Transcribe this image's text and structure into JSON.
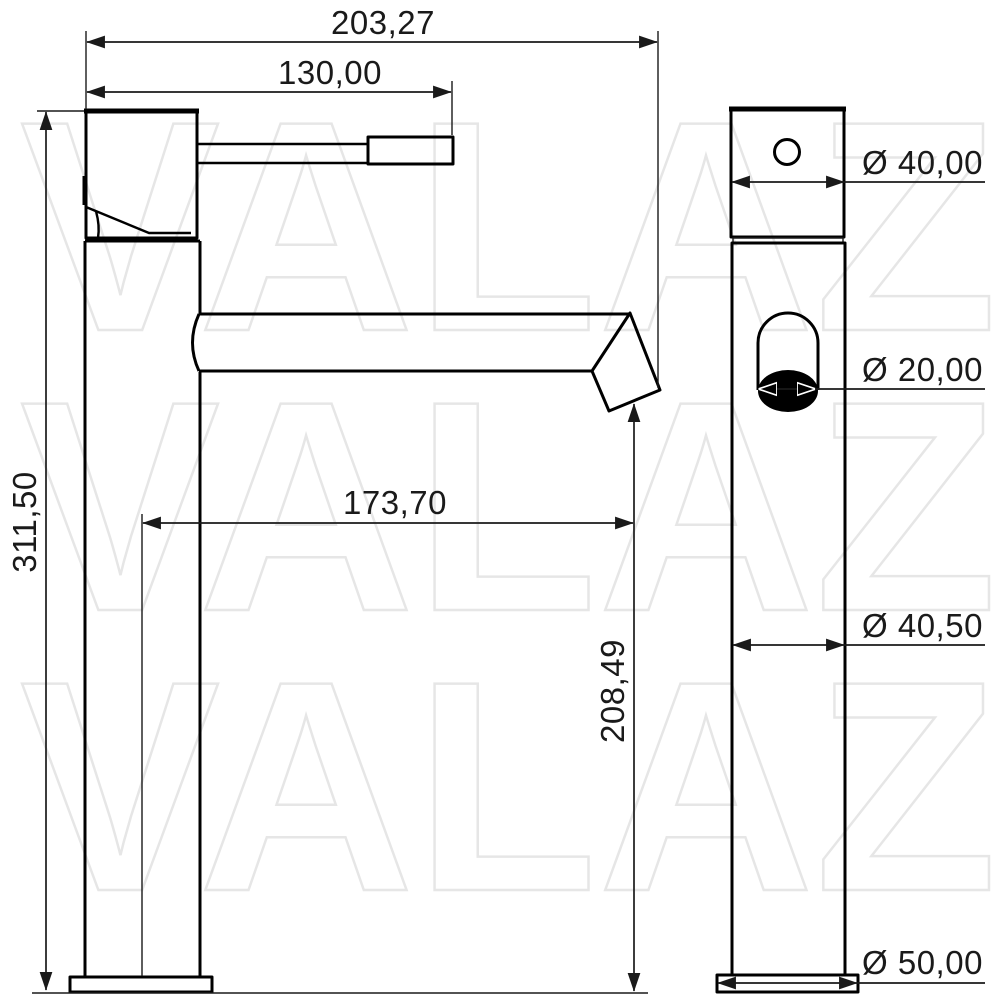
{
  "drawing": {
    "type": "faucet-technical-drawing",
    "background_color": "#ffffff",
    "line_color": "#000000",
    "watermark": {
      "text": "VALAZ",
      "color": "#e6e6e6",
      "repeat_count": 3
    },
    "front_view": {
      "dimensions": [
        {
          "id": "overall-width",
          "label": "203,27"
        },
        {
          "id": "handle-reach",
          "label": "130,00"
        },
        {
          "id": "overall-height",
          "label": "311,50"
        },
        {
          "id": "spout-reach",
          "label": "173,70"
        },
        {
          "id": "spout-outlet-height",
          "label": "208,49"
        }
      ]
    },
    "side_view": {
      "dimensions": [
        {
          "id": "top-body-diameter",
          "label": "Ø 40,00"
        },
        {
          "id": "outlet-diameter",
          "label": "Ø 20,00"
        },
        {
          "id": "column-diameter",
          "label": "Ø 40,50"
        },
        {
          "id": "base-diameter",
          "label": "Ø 50,00"
        }
      ]
    }
  }
}
